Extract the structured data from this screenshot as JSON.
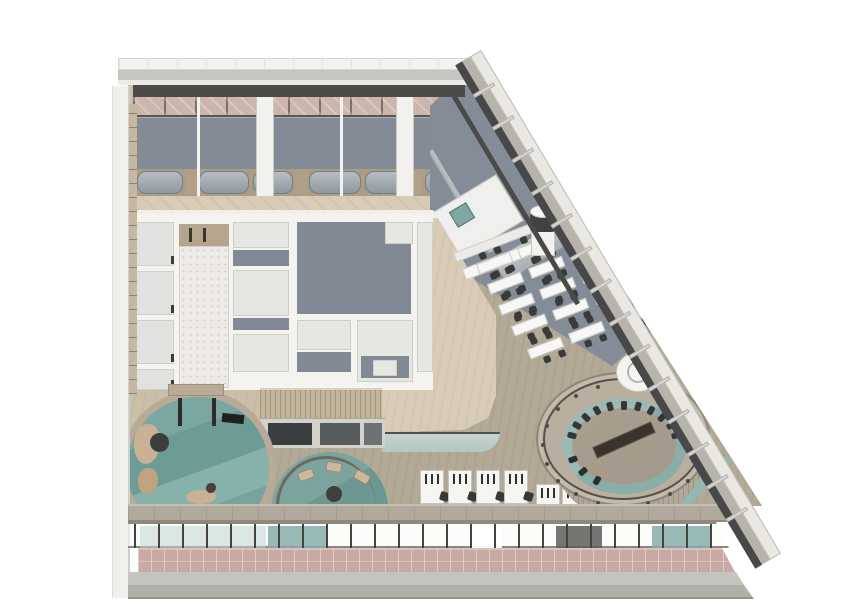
{
  "scene": {
    "title": "axonometric-interior-floor-plan-render",
    "description": "cutaway spa-restaurant floor with circular pools, oval amphitheater, dining rows and glazed facade",
    "background": "#ffffff"
  },
  "palette": {
    "wood_light": "#d8ccb6",
    "wood_base": "#cbbfa9",
    "wood_dark": "#b2a996",
    "gray_floor": "#838c96",
    "pink_panel": "#ccb5ab",
    "charcoal": "#4c4b48",
    "water_teal": "#76a09b",
    "water_pale": "#9cbab4",
    "marble": "#edebe7",
    "terrace_pink": "#c9a9a4",
    "plinth_gray": "#b0b0ab",
    "furniture_white": "#f6f6f3",
    "chair_dark": "#3a3a38",
    "rock_beige": "#c9b193",
    "ring_tan": "#baaf9f"
  },
  "top_rooms": {
    "partitions": [
      {
        "x": 4,
        "w": 46,
        "k": "pill"
      },
      {
        "x": 52,
        "w": 12,
        "k": "wood"
      },
      {
        "x": 66,
        "w": 50,
        "k": "pill"
      },
      {
        "x": 120,
        "w": 40,
        "k": "pill"
      },
      {
        "x": 162,
        "w": 12,
        "k": "wood"
      },
      {
        "x": 176,
        "w": 52,
        "k": "pill"
      },
      {
        "x": 232,
        "w": 44,
        "k": "pill"
      },
      {
        "x": 278,
        "w": 12,
        "k": "wood"
      },
      {
        "x": 292,
        "w": 46,
        "k": "pill"
      }
    ],
    "thin_dividers": [
      197,
      340
    ],
    "thick_dividers": [
      256,
      396
    ]
  },
  "rooms_left_column": {
    "cells_y": [
      8,
      57,
      106,
      155
    ],
    "cell_h": [
      44,
      44,
      44,
      21
    ]
  },
  "dining": {
    "angle_deg": -21,
    "table_w": 36,
    "table_gap": 8,
    "rows": [
      {
        "x": 478,
        "y": 264,
        "tables": 2
      },
      {
        "x": 489,
        "y": 284,
        "tables": 3
      },
      {
        "x": 500,
        "y": 305,
        "tables": 3
      },
      {
        "x": 513,
        "y": 326,
        "tables": 4
      },
      {
        "x": 529,
        "y": 349,
        "tables": 4
      }
    ]
  },
  "desks": {
    "upper_xs": [
      420,
      448,
      476,
      504
    ],
    "upper_y": 470,
    "lower_xs": [
      424,
      452,
      480
    ],
    "lower_y": 514,
    "side_xs": [
      536,
      562
    ],
    "side_y": 484
  },
  "pool_main": {
    "cx": 198,
    "cy": 468,
    "r": 78,
    "posts_x": [
      178,
      212
    ],
    "posts_y": 398,
    "rocks": [
      {
        "x": 134,
        "y": 424,
        "w": 26,
        "h": 40,
        "c": "#c9b193"
      },
      {
        "x": 138,
        "y": 468,
        "w": 20,
        "h": 26,
        "c": "#bfa27e"
      },
      {
        "x": 186,
        "y": 490,
        "w": 30,
        "h": 14,
        "c": "#c9b193"
      },
      {
        "x": 206,
        "y": 483,
        "w": 10,
        "h": 10,
        "c": "#4a4038"
      }
    ]
  },
  "lounge2": {
    "chairs": [
      {
        "x": 298,
        "y": 470,
        "r": -20
      },
      {
        "x": 326,
        "y": 462,
        "r": 10
      },
      {
        "x": 354,
        "y": 472,
        "r": 30
      }
    ],
    "table": {
      "x": 326,
      "y": 486,
      "d": 16
    }
  },
  "arena": {
    "seats_upper": {
      "cx": 624,
      "cy": 446,
      "rx": 54,
      "ry": 40,
      "from": 195,
      "to": 345,
      "step": 15
    },
    "seats_lower": [
      120,
      140,
      160
    ],
    "rail_posts": {
      "cx": 623,
      "cy": 445,
      "rx": 80,
      "ry": 61,
      "count": 20
    }
  },
  "diagonal_wall": {
    "fins": {
      "start": 34,
      "step": 38,
      "count": 14
    }
  },
  "window_band": {
    "mullions": {
      "start": 6,
      "end": 586,
      "step": 24
    },
    "panes": [
      {
        "x": 140,
        "w": 126,
        "c": "rgba(190,214,210,.55)"
      },
      {
        "x": 268,
        "w": 60,
        "c": "rgba(134,173,168,.85)"
      },
      {
        "x": 472,
        "w": 30,
        "c": "rgba(255,255,255,.95)"
      },
      {
        "x": 556,
        "w": 46,
        "c": "rgba(92,94,92,.85)"
      },
      {
        "x": 652,
        "w": 58,
        "c": "rgba(134,173,168,.85)"
      }
    ]
  },
  "wall_band_windows": [
    {
      "x": 8,
      "w": 44,
      "c": "#3a3e40"
    },
    {
      "x": 60,
      "w": 40,
      "c": "#565b5d"
    },
    {
      "x": 104,
      "w": 18,
      "c": "#6d7274"
    }
  ]
}
